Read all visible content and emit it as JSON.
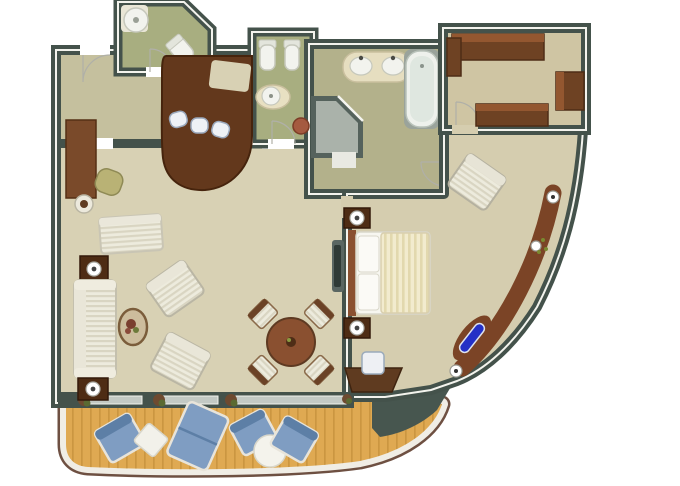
{
  "image": {
    "type": "3d-rendered-floor-plan",
    "subject": "suite floor plan with curved balcony deck",
    "visible_text": ""
  },
  "palette": {
    "wall": "#44524b",
    "wallFace": "#f3f3ed",
    "carpet": "#d8d1b4",
    "hallway": "#c5c09e",
    "green": "#a8ae80",
    "bath": "#b3b18b",
    "dressing": "#cfc5a3",
    "bedroomCarpet": "#d5cdaf",
    "deck": "#dfa952",
    "plank": "#b8832f",
    "rail": "#f0ede5",
    "railEdge": "#6e5042",
    "wedge": "#47564f",
    "glass": "#c3c9c4",
    "barWood": "#63381c",
    "darkWood": "#4e2c14",
    "midWood": "#7a4a2a",
    "consoleWood": "#7b4426",
    "wardrobeWood": "#6e4223",
    "wardrobeTop": "#935730",
    "tableWood": "#8a5030",
    "blue": "#7f9dc2",
    "blueEdge": "#5d7fa6",
    "accentBlue": "#2430c6",
    "fixtureWhite": "#f2f3ee",
    "showerGray": "#55625c",
    "showerTray": "#aab2aa",
    "terracotta": "#a55a40",
    "plantBrown": "#6e4a30",
    "plantGreen": "#5a6a32"
  },
  "rooms": [
    {
      "id": "entry-hall",
      "furniture": []
    },
    {
      "id": "powder-room",
      "furniture": [
        "corner-sink",
        "toilet"
      ]
    },
    {
      "id": "bar-pantry",
      "furniture": [
        "curved-bar-counter",
        "bar-stool",
        "bar-stool",
        "bar-stool"
      ]
    },
    {
      "id": "wc-room",
      "furniture": [
        "toilet",
        "bidet",
        "basin-counter"
      ]
    },
    {
      "id": "bathroom",
      "furniture": [
        "double-sink-vanity",
        "bathtub",
        "corner-shower",
        "stool"
      ]
    },
    {
      "id": "dressing-room",
      "furniture": [
        "wardrobe",
        "wardrobe",
        "dresser"
      ]
    },
    {
      "id": "living-dining-room",
      "furniture": [
        "writing-desk",
        "desk-chair",
        "lamp-table",
        "chaise-longue",
        "lamp-cabinet",
        "sofa",
        "lamp-cabinet",
        "oval-coffee-table-with-plant",
        "armchair",
        "armchair",
        "round-dining-table",
        "dining-chair",
        "dining-chair",
        "dining-chair",
        "dining-chair",
        "tv-console"
      ]
    },
    {
      "id": "bedroom",
      "furniture": [
        "double-bed",
        "nightstand-with-lamp",
        "nightstand-with-lamp",
        "armchair",
        "vanity-desk",
        "vanity-chair",
        "curved-wall-console-with-lamps"
      ]
    },
    {
      "id": "balcony",
      "furniture": [
        "deck-chair",
        "square-side-table",
        "double-chaise",
        "deck-chair",
        "round-table",
        "deck-chair"
      ]
    }
  ]
}
